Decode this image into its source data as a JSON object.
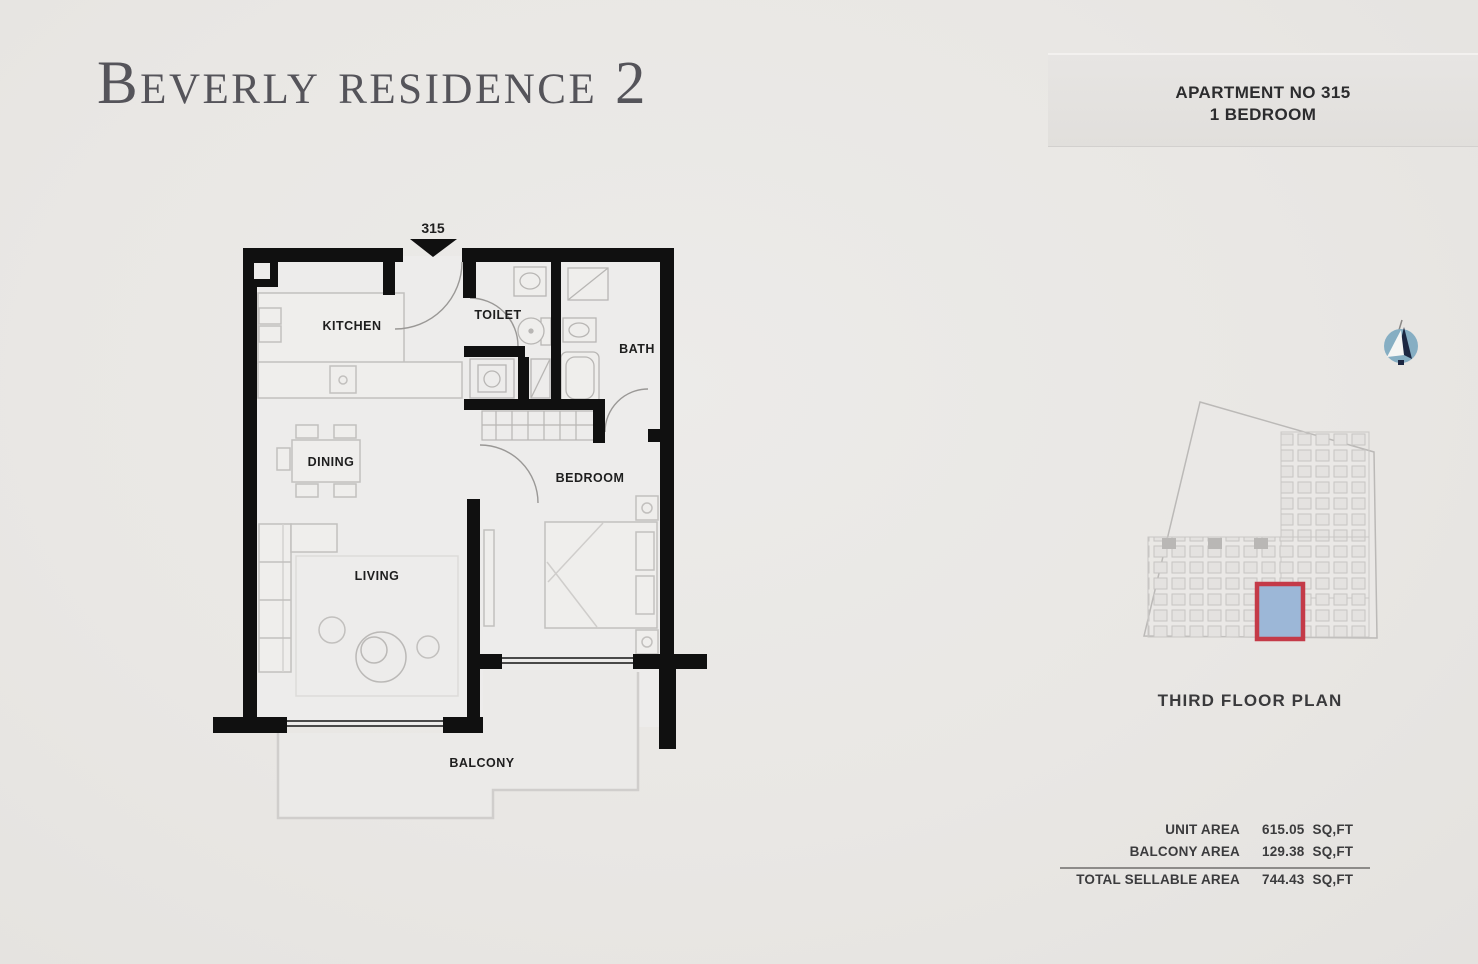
{
  "title": "Beverly residence 2",
  "header": {
    "line1": "APARTMENT NO 315",
    "line2": "1 BEDROOM"
  },
  "floorplan": {
    "unit_label": "315",
    "rooms": {
      "kitchen": "KITCHEN",
      "toilet": "TOILET",
      "bath": "BATH",
      "dining": "DINING",
      "bedroom": "BEDROOM",
      "living": "LIVING",
      "balcony": "BALCONY"
    }
  },
  "site_plan": {
    "caption": "THIRD FLOOR PLAN",
    "highlight_border_color": "#c43a48",
    "highlight_fill_color": "#9cb7d7"
  },
  "areas": {
    "rows": [
      {
        "label": "UNIT AREA",
        "value": "615.05",
        "unit": "SQ,FT"
      },
      {
        "label": "BALCONY  AREA",
        "value": "129.38",
        "unit": "SQ,FT"
      },
      {
        "label": "TOTAL SELLABLE AREA",
        "value": "744.43",
        "unit": "SQ,FT"
      }
    ]
  },
  "colors": {
    "wall": "#101010",
    "furniture_line": "#c2c0be",
    "background": "#e9e7e4"
  }
}
